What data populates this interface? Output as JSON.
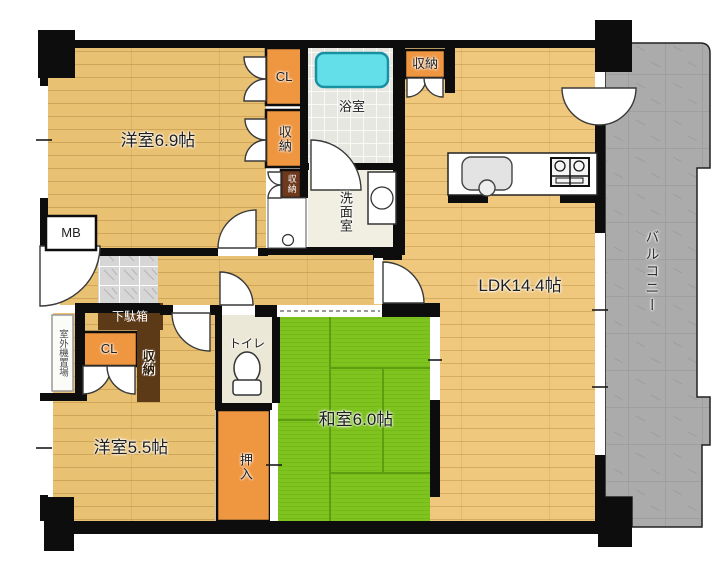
{
  "rooms": {
    "bedroom1": {
      "label": "洋室6.9帖"
    },
    "bedroom2": {
      "label": "洋室5.5帖"
    },
    "washitsu": {
      "label": "和室6.0帖"
    },
    "ldk": {
      "label": "LDK14.4帖"
    },
    "bath": {
      "label": "浴室"
    },
    "washroom": {
      "label": "洗面室"
    },
    "toilet": {
      "label": "トイレ"
    },
    "balcony": {
      "label": "バルコニー"
    },
    "oshiire": {
      "label": "押入"
    }
  },
  "storage": {
    "closet_top": {
      "label": "CL"
    },
    "closet_entry": {
      "label": "CL"
    },
    "storage_mid": {
      "label": "収納"
    },
    "storage_small": {
      "label": "収納"
    },
    "storage_kitchen": {
      "label": "収納"
    },
    "storage_entry": {
      "label": "収納"
    },
    "shoe_box": {
      "label": "下駄箱"
    }
  },
  "annotations": {
    "meter_box": {
      "label": "MB"
    },
    "outdoor_unit": {
      "label": "室外機置場"
    }
  },
  "colors": {
    "wall": "#0d0d0d",
    "wood": "#e9c172",
    "wood-ldk": "#efc87e",
    "tatami": "#7ec31e",
    "tatami-line": "#5c9e10",
    "balcony": "#ababab",
    "closet-orange": "#ef9640",
    "cabinet-brown": "#5d3a17",
    "tub-cyan": "#63dfe9",
    "bath-floor": "#e7e7e1",
    "wash-floor": "#f1efe2",
    "toilet-floor": "#ece8d7",
    "genkan-tile": "#d6d6d6"
  }
}
